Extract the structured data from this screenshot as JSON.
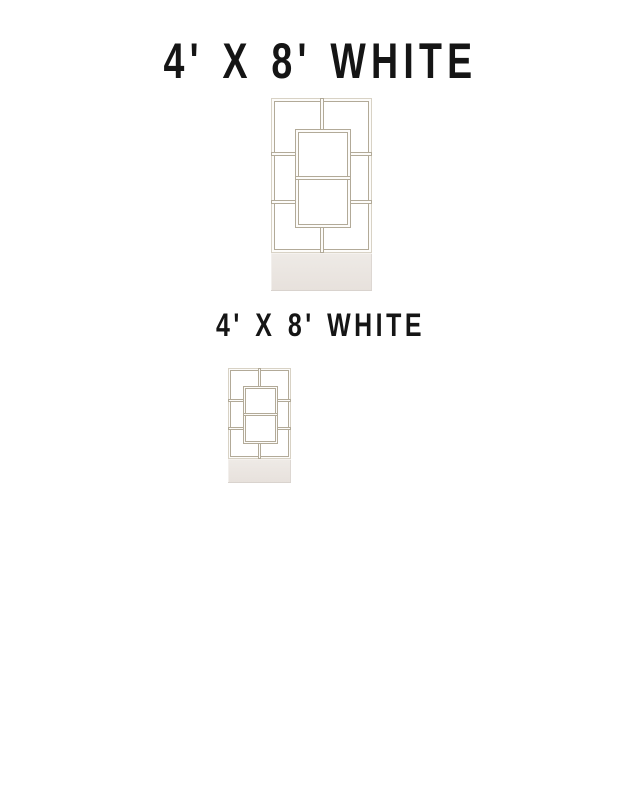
{
  "products": {
    "primary": {
      "title": "4' X 8' WHITE"
    },
    "secondary": {
      "title": "4' X 8' WHITE"
    }
  },
  "graphic": {
    "description": "white geometric openwork room divider with planter box base",
    "frame_line_color": "#b2aa98",
    "frame_fill_color": "#fdfcfa",
    "planter_color": "#e9e4df",
    "title_color": "#151515",
    "background_color": "#ffffff"
  }
}
